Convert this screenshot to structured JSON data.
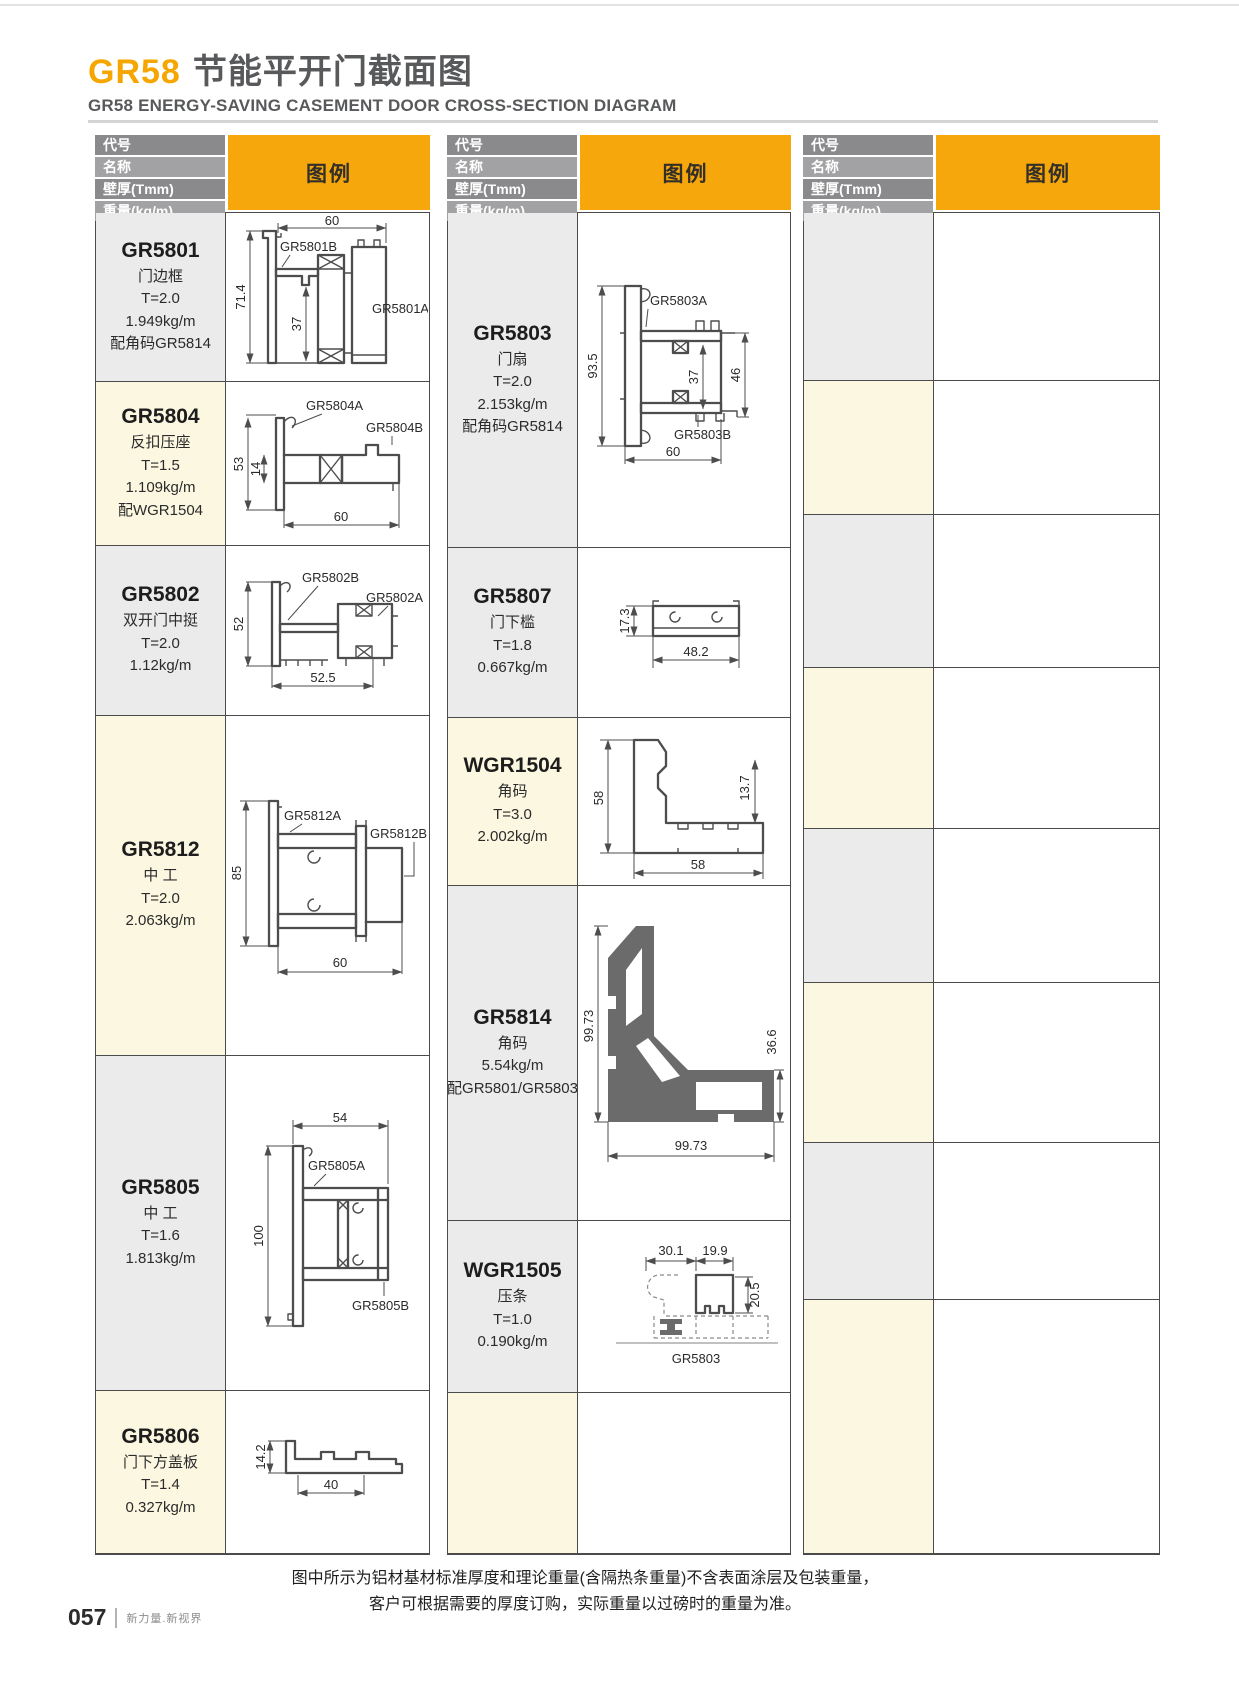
{
  "page": {
    "title_code": "GR58",
    "title_zh": "节能平开门截面图",
    "title_en": "GR58 ENERGY-SAVING CASEMENT DOOR CROSS-SECTION DIAGRAM",
    "note_line1": "图中所示为铝材基材标准厚度和理论重量(含隔热条重量)不含表面涂层及包装重量，",
    "note_line2": "客户可根据需要的厚度订购，实际重量以过磅时的重量为准。",
    "page_number": "057",
    "footer_slogan": "新力量.新视界"
  },
  "header_labels": {
    "code": "代号",
    "name": "名称",
    "thickness": "壁厚(Tmm)",
    "weight": "重量(kg/m)",
    "legend": "图例"
  },
  "colors": {
    "accent_yellow": "#f5a70b",
    "title_orange": "#f5a600",
    "title_gray": "#58595b",
    "header_gray_dark": "#8a8a8c",
    "header_gray_light": "#a2a2a4",
    "cell_gray": "#ebebec",
    "cell_cream": "#fbf7e0",
    "table_line": "#4b4b4b",
    "diagram_stroke": "#4d4d4d"
  },
  "products": {
    "gr5801": {
      "code": "GR5801",
      "info": [
        "门边框",
        "T=2.0",
        "1.949kg/m",
        "配角码GR5814"
      ],
      "dims": {
        "top": "60",
        "height": "71.4",
        "inner": "37"
      },
      "labels": {
        "a": "GR5801A",
        "b": "GR5801B"
      }
    },
    "gr5804": {
      "code": "GR5804",
      "info": [
        "反扣压座",
        "T=1.5",
        "1.109kg/m",
        "配WGR1504"
      ],
      "dims": {
        "height": "53",
        "inner": "14",
        "bottom": "60"
      },
      "labels": {
        "a": "GR5804A",
        "b": "GR5804B"
      }
    },
    "gr5802": {
      "code": "GR5802",
      "info": [
        "双开门中挺",
        "T=2.0",
        "1.12kg/m"
      ],
      "dims": {
        "height": "52",
        "bottom": "52.5"
      },
      "labels": {
        "a": "GR5802A",
        "b": "GR5802B"
      }
    },
    "gr5812": {
      "code": "GR5812",
      "info": [
        "中 工",
        "T=2.0",
        "2.063kg/m"
      ],
      "dims": {
        "height": "85",
        "bottom": "60"
      },
      "labels": {
        "a": "GR5812A",
        "b": "GR5812B"
      }
    },
    "gr5805": {
      "code": "GR5805",
      "info": [
        "中 工",
        "T=1.6",
        "1.813kg/m"
      ],
      "dims": {
        "top": "54",
        "height": "100"
      },
      "labels": {
        "a": "GR5805A",
        "b": "GR5805B"
      }
    },
    "gr5806": {
      "code": "GR5806",
      "info": [
        "门下方盖板",
        "T=1.4",
        "0.327kg/m"
      ],
      "dims": {
        "height": "14.2",
        "bottom": "40"
      }
    },
    "gr5803": {
      "code": "GR5803",
      "info": [
        "门扇",
        "T=2.0",
        "2.153kg/m",
        "配角码GR5814"
      ],
      "dims": {
        "height": "93.5",
        "inner": "37",
        "right": "46",
        "bottom": "60"
      },
      "labels": {
        "a": "GR5803A",
        "b": "GR5803B"
      }
    },
    "gr5807": {
      "code": "GR5807",
      "info": [
        "门下槛",
        "T=1.8",
        "0.667kg/m"
      ],
      "dims": {
        "height": "17.3",
        "bottom": "48.2"
      }
    },
    "wgr1504": {
      "code": "WGR1504",
      "info": [
        "角码",
        "T=3.0",
        "2.002kg/m"
      ],
      "dims": {
        "height": "58",
        "right": "13.7",
        "bottom": "58"
      }
    },
    "gr5814": {
      "code": "GR5814",
      "info": [
        "角码",
        "5.54kg/m",
        "配GR5801/GR5803"
      ],
      "dims": {
        "height": "99.73",
        "right": "36.6",
        "bottom": "99.73"
      }
    },
    "wgr1505": {
      "code": "WGR1505",
      "info": [
        "压条",
        "T=1.0",
        "0.190kg/m"
      ],
      "dims": {
        "top1": "30.1",
        "top2": "19.9",
        "right": "20.5"
      },
      "labels": {
        "ref": "GR5803"
      }
    }
  }
}
